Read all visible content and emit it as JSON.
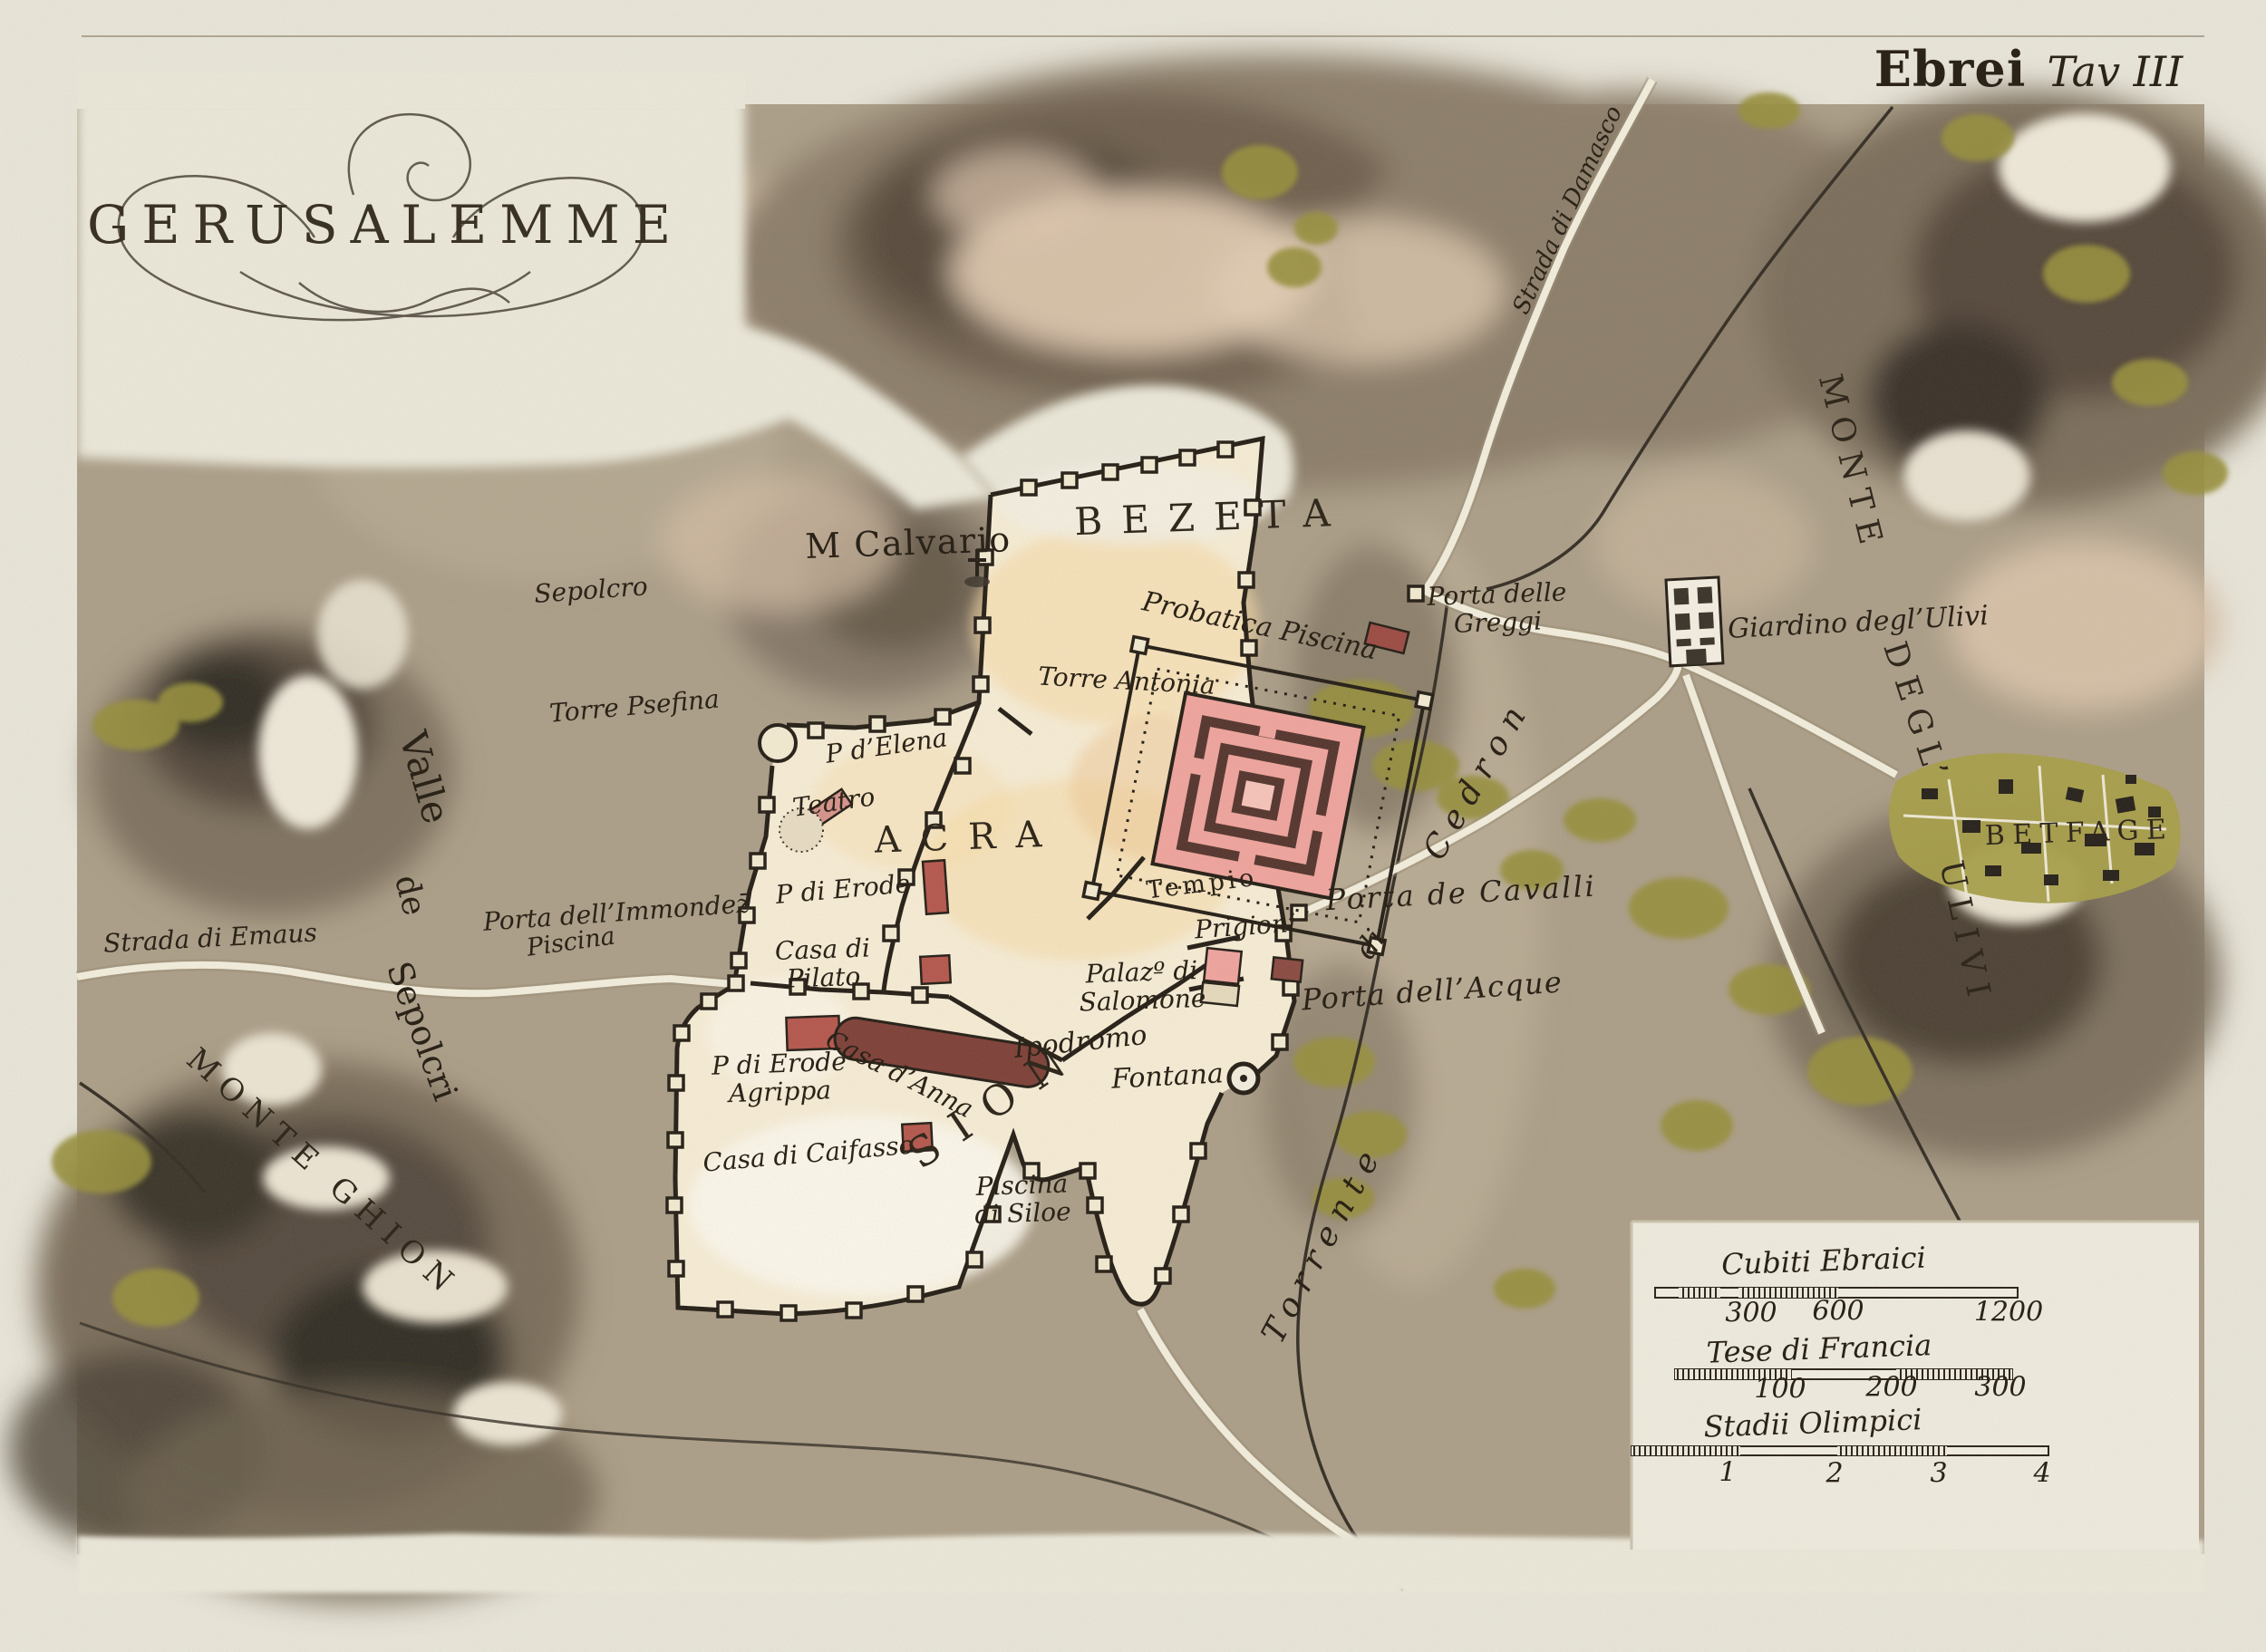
{
  "title": "GERUSALEMME",
  "plate": {
    "series": "Ebrei",
    "plate_no": "Tav III"
  },
  "palette": {
    "paper": "#e9e6da",
    "terrain": "#ac9f89",
    "hill_dark": "#5e5244",
    "city_fill": "#f7edd6",
    "wall_ink": "#26201a",
    "temple_pink": "#efa49e",
    "temple_maroon": "#55352e",
    "building_red": "#b5574e",
    "vegetation_green": "#97903c",
    "road_white": "#f3eedd",
    "text_ink": "#2b2318"
  },
  "scales": [
    {
      "name": "Cubiti Ebraici",
      "values": [
        300,
        600,
        1200
      ]
    },
    {
      "name": "Tese di Francia",
      "values": [
        100,
        200,
        300
      ]
    },
    {
      "name": "Stadii Olimpici",
      "values": [
        1,
        2,
        3,
        4
      ]
    }
  ],
  "map": {
    "labels": [
      {
        "id": "sepolcro",
        "text": "Sepolcro",
        "x": 652,
        "y": 652,
        "rot": -4,
        "size": 28,
        "cls": "it"
      },
      {
        "id": "torre-psefina",
        "text": "Torre Psefina",
        "x": 700,
        "y": 780,
        "rot": -5,
        "size": 28,
        "cls": "it"
      },
      {
        "id": "valle",
        "text": "Valle",
        "x": 468,
        "y": 858,
        "rot": 74,
        "size": 42,
        "cls": "rm"
      },
      {
        "id": "valle-de",
        "text": "de",
        "x": 452,
        "y": 988,
        "rot": 76,
        "size": 36,
        "cls": "rm"
      },
      {
        "id": "valle-sepolcri",
        "text": "Sepolcri",
        "x": 465,
        "y": 1138,
        "rot": 70,
        "size": 38,
        "cls": "rm"
      },
      {
        "id": "monte-ghion",
        "text": "MONTE GHION",
        "x": 356,
        "y": 1295,
        "rot": 42,
        "size": 34,
        "cls": "caps",
        "ls": ".3em"
      },
      {
        "id": "strada-emaus",
        "text": "Strada di Emaus",
        "x": 232,
        "y": 1036,
        "rot": -3,
        "size": 28,
        "cls": "it"
      },
      {
        "id": "porta-immondez",
        "text": "Porta dell’Immondez̄",
        "x": 680,
        "y": 1008,
        "rot": -4,
        "size": 28,
        "cls": "it"
      },
      {
        "id": "piscina-west",
        "text": "Piscina",
        "x": 630,
        "y": 1040,
        "rot": -8,
        "size": 27,
        "cls": "it"
      },
      {
        "id": "m-calvario",
        "text": "M Calvario",
        "x": 1002,
        "y": 600,
        "rot": -2,
        "size": 38,
        "cls": "rm",
        "ls": ".04em"
      },
      {
        "id": "bezeta",
        "text": "BEZETA",
        "x": 1337,
        "y": 571,
        "rot": -2,
        "size": 42,
        "cls": "caps",
        "ls": ".5em"
      },
      {
        "id": "probatica",
        "text": "Probatica Piscina",
        "x": 1390,
        "y": 691,
        "rot": 12,
        "size": 30,
        "cls": "it"
      },
      {
        "id": "torre-antonia",
        "text": "Torre Antonia",
        "x": 1243,
        "y": 752,
        "rot": 3,
        "size": 28,
        "cls": "it"
      },
      {
        "id": "p-elena",
        "text": "P d’Elena",
        "x": 978,
        "y": 824,
        "rot": -8,
        "size": 28,
        "cls": "it"
      },
      {
        "id": "teatro",
        "text": "Teatro",
        "x": 920,
        "y": 886,
        "rot": -8,
        "size": 28,
        "cls": "it"
      },
      {
        "id": "acra",
        "text": "ACRA",
        "x": 1068,
        "y": 924,
        "rot": -2,
        "size": 40,
        "cls": "caps",
        "ls": ".55em"
      },
      {
        "id": "p-erode",
        "text": "P di Erode",
        "x": 930,
        "y": 982,
        "rot": -5,
        "size": 28,
        "cls": "it"
      },
      {
        "id": "casa-pilato",
        "text": "Casa di\nPilato",
        "x": 908,
        "y": 1064,
        "rot": -2,
        "size": 28,
        "cls": "it"
      },
      {
        "id": "tempio",
        "text": "Tempio",
        "x": 1326,
        "y": 976,
        "rot": -7,
        "size": 27,
        "cls": "rm",
        "ls": ".14em"
      },
      {
        "id": "palazzo-salomone",
        "text": "Palazº di\nSalomone",
        "x": 1260,
        "y": 1089,
        "rot": -2,
        "size": 28,
        "cls": "it"
      },
      {
        "id": "prigioni",
        "text": "Prigioni",
        "x": 1374,
        "y": 1023,
        "rot": -4,
        "size": 28,
        "cls": "it"
      },
      {
        "id": "porta-cavalli",
        "text": "Porta de Cavalli",
        "x": 1612,
        "y": 986,
        "rot": -3,
        "size": 32,
        "cls": "it",
        "ls": ".08em"
      },
      {
        "id": "porta-acque",
        "text": "Porta dell’Acque",
        "x": 1580,
        "y": 1094,
        "rot": -4,
        "size": 32,
        "cls": "it",
        "ls": ".04em"
      },
      {
        "id": "ipodromo",
        "text": "Ipodromo",
        "x": 1192,
        "y": 1150,
        "rot": -6,
        "size": 30,
        "cls": "it"
      },
      {
        "id": "casa-anna",
        "text": "Casa d’Anna",
        "x": 992,
        "y": 1186,
        "rot": 27,
        "size": 28,
        "cls": "it"
      },
      {
        "id": "erode-agrippa",
        "text": "P di Erode\nAgrippa",
        "x": 860,
        "y": 1190,
        "rot": -2,
        "size": 28,
        "cls": "it"
      },
      {
        "id": "casa-caifasso",
        "text": "Casa di Caifasso",
        "x": 892,
        "y": 1274,
        "rot": -5,
        "size": 28,
        "cls": "it"
      },
      {
        "id": "sion",
        "text": "SION",
        "x": 1098,
        "y": 1217,
        "rot": -34,
        "size": 46,
        "cls": "caps",
        "ls": ".5em"
      },
      {
        "id": "piscina-siloe",
        "text": "Piscina\ndi Siloe",
        "x": 1128,
        "y": 1324,
        "rot": -2,
        "size": 28,
        "cls": "it"
      },
      {
        "id": "fontana",
        "text": "Fontana",
        "x": 1288,
        "y": 1188,
        "rot": -3,
        "size": 30,
        "cls": "it"
      },
      {
        "id": "torrente",
        "text": "Torrente",
        "x": 1460,
        "y": 1372,
        "rot": -62,
        "size": 36,
        "cls": "it",
        "ls": ".3em"
      },
      {
        "id": "torrente-di",
        "text": "di",
        "x": 1512,
        "y": 1042,
        "rot": -55,
        "size": 32,
        "cls": "it"
      },
      {
        "id": "cedron",
        "text": "Cedron",
        "x": 1630,
        "y": 860,
        "rot": -60,
        "size": 36,
        "cls": "it",
        "ls": ".3em"
      },
      {
        "id": "porta-greggi",
        "text": "Porta delle\nGreggi",
        "x": 1652,
        "y": 672,
        "rot": -2,
        "size": 28,
        "cls": "it"
      },
      {
        "id": "strada-damasco",
        "text": "Strada di Damasco",
        "x": 1730,
        "y": 232,
        "rot": -65,
        "size": 26,
        "cls": "it"
      },
      {
        "id": "giardino-ulivi",
        "text": "Giardino degl’Ulivi",
        "x": 2050,
        "y": 687,
        "rot": -3,
        "size": 30,
        "cls": "it"
      },
      {
        "id": "betfage",
        "text": "BETFAGE",
        "x": 2294,
        "y": 919,
        "rot": -2,
        "size": 30,
        "cls": "caps",
        "ls": ".28em"
      },
      {
        "id": "monte-ulivi-1",
        "text": "MONTE",
        "x": 2042,
        "y": 512,
        "rot": 76,
        "size": 36,
        "cls": "caps",
        "ls": ".3em"
      },
      {
        "id": "monte-ulivi-2",
        "text": "DEGL’",
        "x": 2114,
        "y": 788,
        "rot": 72,
        "size": 36,
        "cls": "caps",
        "ls": ".3em"
      },
      {
        "id": "monte-ulivi-3",
        "text": "ULIVI",
        "x": 2168,
        "y": 1030,
        "rot": 78,
        "size": 36,
        "cls": "caps",
        "ls": ".3em"
      },
      {
        "id": "scale-cubiti",
        "text": "Cubiti Ebraici",
        "x": 2012,
        "y": 1392,
        "rot": -2,
        "size": 32,
        "cls": "it"
      },
      {
        "id": "cubiti-300",
        "text": "300",
        "x": 1932,
        "y": 1449,
        "rot": 0,
        "size": 30,
        "cls": "it"
      },
      {
        "id": "cubiti-600",
        "text": "600",
        "x": 2028,
        "y": 1447,
        "rot": 0,
        "size": 30,
        "cls": "it"
      },
      {
        "id": "cubiti-1200",
        "text": "1200",
        "x": 2216,
        "y": 1448,
        "rot": 0,
        "size": 30,
        "cls": "it"
      },
      {
        "id": "scale-tese",
        "text": "Tese di Francia",
        "x": 2007,
        "y": 1489,
        "rot": -2,
        "size": 32,
        "cls": "it"
      },
      {
        "id": "tese-100",
        "text": "100",
        "x": 1964,
        "y": 1533,
        "rot": 0,
        "size": 30,
        "cls": "it"
      },
      {
        "id": "tese-200",
        "text": "200",
        "x": 2087,
        "y": 1531,
        "rot": 0,
        "size": 30,
        "cls": "it"
      },
      {
        "id": "tese-300",
        "text": "300",
        "x": 2207,
        "y": 1531,
        "rot": 0,
        "size": 30,
        "cls": "it"
      },
      {
        "id": "scale-stadii",
        "text": "Stadii Olimpici",
        "x": 2000,
        "y": 1571,
        "rot": -2,
        "size": 32,
        "cls": "it"
      },
      {
        "id": "stadii-1",
        "text": "1",
        "x": 1906,
        "y": 1625,
        "rot": 0,
        "size": 30,
        "cls": "it"
      },
      {
        "id": "stadii-2",
        "text": "2",
        "x": 2024,
        "y": 1626,
        "rot": 0,
        "size": 30,
        "cls": "it"
      },
      {
        "id": "stadii-3",
        "text": "3",
        "x": 2139,
        "y": 1626,
        "rot": 0,
        "size": 30,
        "cls": "it"
      },
      {
        "id": "stadii-4",
        "text": "4",
        "x": 2253,
        "y": 1626,
        "rot": 0,
        "size": 30,
        "cls": "it"
      }
    ]
  }
}
